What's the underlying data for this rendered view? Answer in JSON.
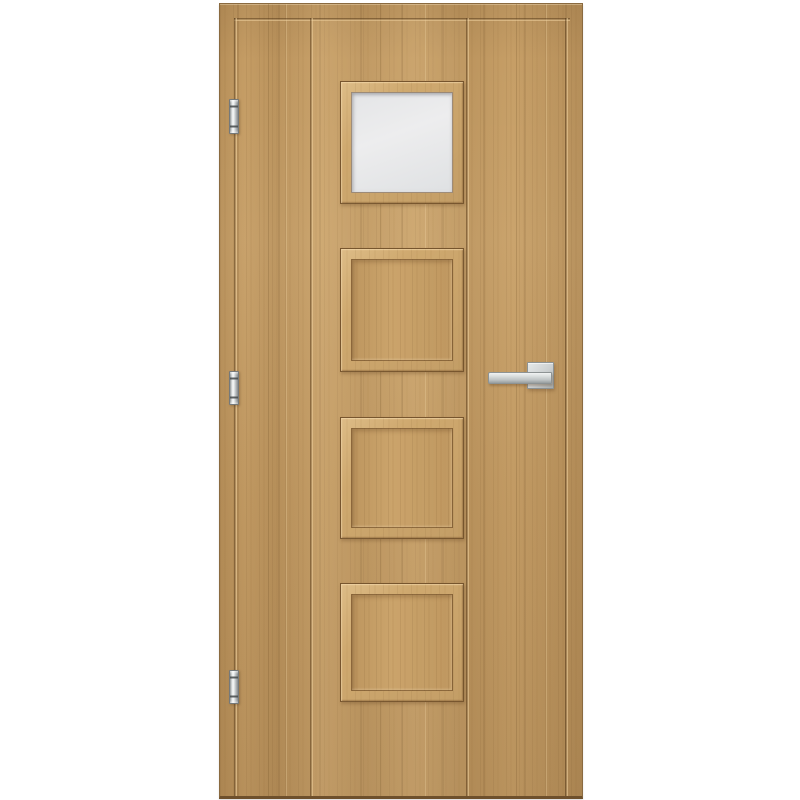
{
  "scene": {
    "type": "product-photo",
    "subject": "Interior door, oak-effect laminate, vertical grain, four square panels in a centre column; top panel is frosted glass, lower three are raised wood panels",
    "background_color": "#ffffff"
  },
  "door": {
    "orientation": "left-hinged, handle on the right",
    "colors": {
      "wood_base": "#c49c64",
      "wood_grain_dark": "#8a6140",
      "panel_frame_light": "#cfa96f",
      "edge_outline": "#8a6a40",
      "bottom_edge": "#6e502c",
      "glass": "#e7e8ea",
      "metal": "#c6cacb"
    },
    "panels": [
      {
        "id": "panel-1",
        "fill": "frosted-glass"
      },
      {
        "id": "panel-2",
        "fill": "wood"
      },
      {
        "id": "panel-3",
        "fill": "wood"
      },
      {
        "id": "panel-4",
        "fill": "wood"
      }
    ],
    "hinges": {
      "count": 3,
      "side": "left",
      "finish": "satin-chrome"
    },
    "handle": {
      "side": "right",
      "style": "square-rosette lever",
      "finish": "satin-chrome"
    },
    "grooves": {
      "top_horizontal": 1,
      "vertical": 4,
      "description": "border grooves near left/right edges plus two grooves framing the panel column"
    }
  }
}
